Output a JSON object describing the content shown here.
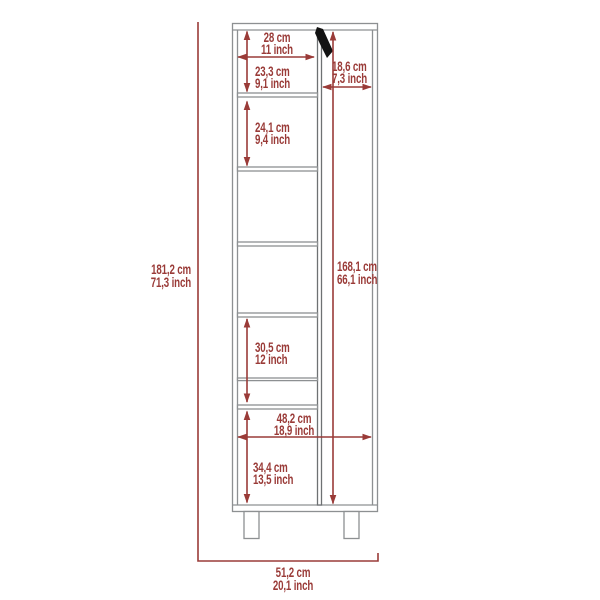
{
  "colors": {
    "dimension_annotation": "#9A3B38",
    "cabinet_outline": "#8D9092",
    "divider_outline": "#6E7173",
    "handle": "#121212",
    "background": "#FFFFFF"
  },
  "dimensions": {
    "overall_height": {
      "cm": "181,2 cm",
      "inch": "71,3 inch"
    },
    "overall_width": {
      "cm": "51,2 cm",
      "inch": "20,1 inch"
    },
    "top_compartment_width": {
      "cm": "28 cm",
      "inch": "11 inch"
    },
    "top_compartment_height": {
      "cm": "23,3 cm",
      "inch": "9,1 inch"
    },
    "door_width": {
      "cm": "18,6 cm",
      "inch": "7,3 inch"
    },
    "second_compartment_height": {
      "cm": "24,1 cm",
      "inch": "9,4 inch"
    },
    "door_height": {
      "cm": "168,1 cm",
      "inch": "66,1 inch"
    },
    "lower_compartment_height": {
      "cm": "30,5 cm",
      "inch": "12 inch"
    },
    "interior_width": {
      "cm": "48,2 cm",
      "inch": "18,9 inch"
    },
    "bottom_compartment_height": {
      "cm": "34,4 cm",
      "inch": "13,5 inch"
    }
  }
}
